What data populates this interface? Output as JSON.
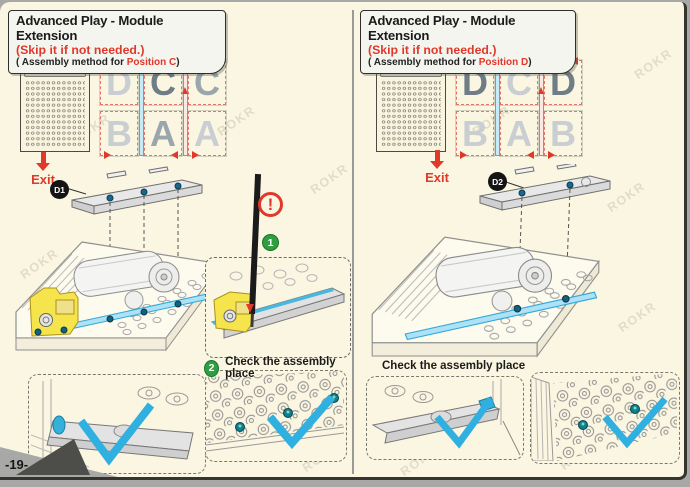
{
  "page": {
    "number": "-19-",
    "watermark": "ROKR"
  },
  "colors": {
    "accent_red": "#e0392b",
    "highlight_cyan": "#2fb0e0",
    "step_green": "#2f9e41",
    "pin_teal": "#0f7f8b",
    "part_yellow": "#f5e44c",
    "screw_blue": "#19688b",
    "paper": "#faf6e1"
  },
  "panels": [
    {
      "title": "Advanced Play - Module Extension",
      "skip_note": "(Skip it if not needed.)",
      "method_prefix": "( Assembly method for ",
      "method_position": "Position C",
      "method_suffix": ")",
      "exit_label": "Exit",
      "part_badge": "D1",
      "grid": [
        {
          "ch": "D",
          "tone": "light"
        },
        {
          "ch": "C",
          "tone": "dark"
        },
        {
          "ch": "C",
          "tone": "mid"
        },
        {
          "ch": "B",
          "tone": "light"
        },
        {
          "ch": "A",
          "tone": "mid"
        },
        {
          "ch": "A",
          "tone": "light"
        }
      ],
      "insert_step_badge": "1",
      "warning_icon": "!",
      "check_step_badge": "2",
      "check_label": "Check the assembly place"
    },
    {
      "title": "Advanced Play - Module Extension",
      "skip_note": "(Skip it if not needed.)",
      "method_prefix": "( Assembly method for ",
      "method_position": "Position D",
      "method_suffix": ")",
      "exit_label": "Exit",
      "part_badge": "D2",
      "grid": [
        {
          "ch": "D",
          "tone": "dark"
        },
        {
          "ch": "C",
          "tone": "light"
        },
        {
          "ch": "D",
          "tone": "dark"
        },
        {
          "ch": "B",
          "tone": "light"
        },
        {
          "ch": "A",
          "tone": "light"
        },
        {
          "ch": "B",
          "tone": "light"
        }
      ],
      "check_label": "Check the assembly place"
    }
  ]
}
